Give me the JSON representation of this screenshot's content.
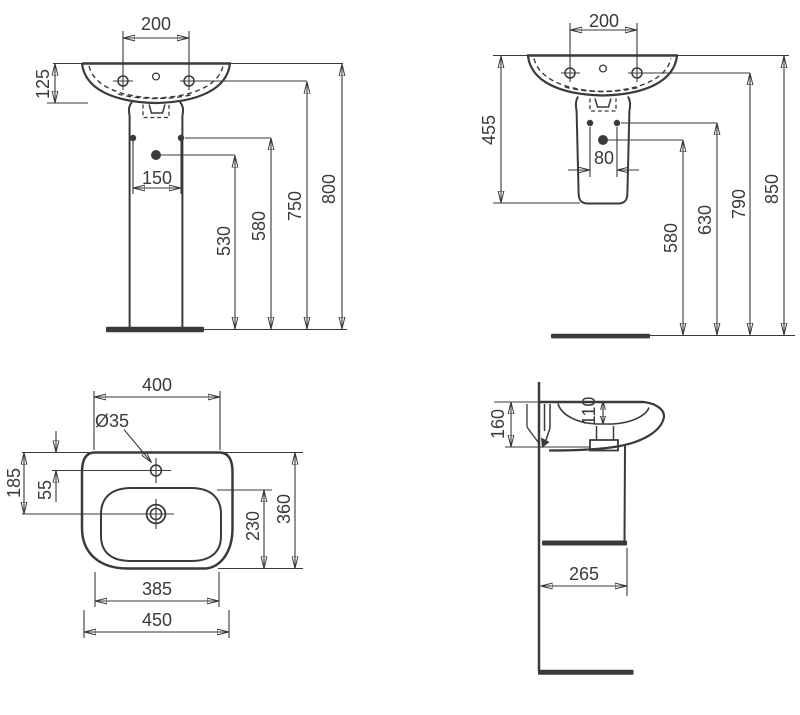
{
  "page": {
    "background": "#ffffff",
    "line_color": "#3a3a3a",
    "kind": "sanitary-ware dimensional drawing"
  },
  "views": {
    "front_with_pedestal": {
      "label": "front view, basin with full pedestal",
      "dims": {
        "tap_hole_spacing": "200",
        "rim_depth": "125",
        "fixing_hole_spacing": "150",
        "drain_outlet_height": "530",
        "fixing_holes_height": "580",
        "rim_underside_height": "750",
        "overall_height": "800"
      }
    },
    "front_with_semi_pedestal": {
      "label": "front view, basin with semi-pedestal",
      "dims": {
        "tap_hole_spacing": "200",
        "basin_semi_pedestal_height": "455",
        "fixing_hole_spacing": "80",
        "drain_outlet_height": "580",
        "fixing_holes_height": "630",
        "rim_underside_height": "790",
        "overall_height": "850"
      }
    },
    "plan": {
      "label": "top view of basin",
      "dims": {
        "rear_width": "400",
        "tap_hole_diameter": "Ø35",
        "rear_to_drain": "185",
        "rear_to_tap_hole": "55",
        "bowl_depth": "230",
        "overall_depth": "360",
        "front_width": "385",
        "overall_width": "450"
      }
    },
    "side": {
      "label": "side section view",
      "dims": {
        "basin_height": "160",
        "bowl_inner_depth": "110",
        "depth_from_wall": "265"
      }
    }
  }
}
